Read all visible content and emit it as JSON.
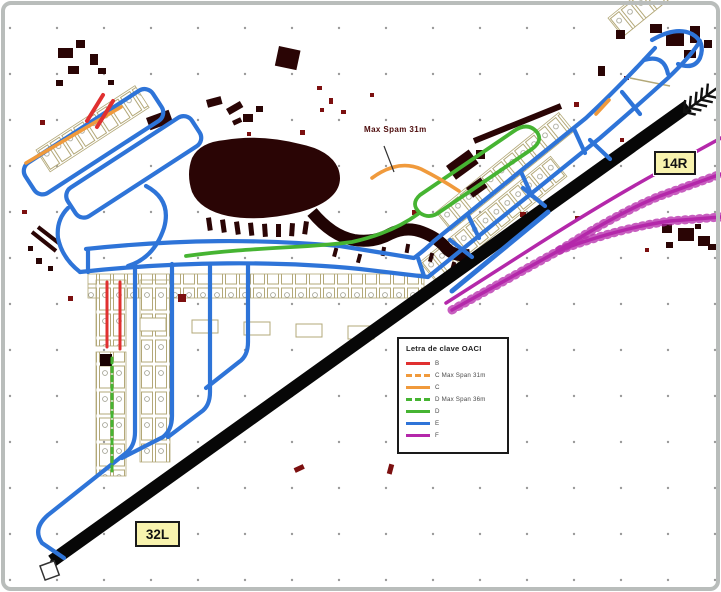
{
  "figure": {
    "type": "airport-ground-movement-chart",
    "description": "Aerodrome taxiway chart colour-coded by ICAO code letter"
  },
  "labels": {
    "runway_end_top": "14R",
    "runway_end_bottom": "32L",
    "annotation": "Max Spam 31m"
  },
  "legend": {
    "title": "Letra de clave OACI",
    "items": [
      {
        "label": "B",
        "color": "#e03030",
        "line_style": "solid"
      },
      {
        "label": "C Max Span 31m",
        "color": "#f09a3c",
        "line_style": "dashed"
      },
      {
        "label": "C",
        "color": "#f09a3c",
        "line_style": "solid"
      },
      {
        "label": "D Max Span 36m",
        "color": "#46b432",
        "line_style": "dashed"
      },
      {
        "label": "D",
        "color": "#46b432",
        "line_style": "solid"
      },
      {
        "label": "E",
        "color": "#2e74d8",
        "line_style": "solid"
      },
      {
        "label": "F",
        "color": "#b428aa",
        "line_style": "solid"
      }
    ]
  },
  "colors": {
    "code_b": "#e03030",
    "code_c": "#f09a3c",
    "code_d": "#46b432",
    "code_e": "#2e74d8",
    "code_f": "#b428aa",
    "runway": "#070707",
    "buildings": "#2a0505",
    "building_red": "#7c1010",
    "stands_outline": "#b3a878",
    "grid_dot": "#999999",
    "label_bg": "#f8f3ae",
    "label_border": "#1a1a1a",
    "annotation_text": "#4c0a0a"
  }
}
